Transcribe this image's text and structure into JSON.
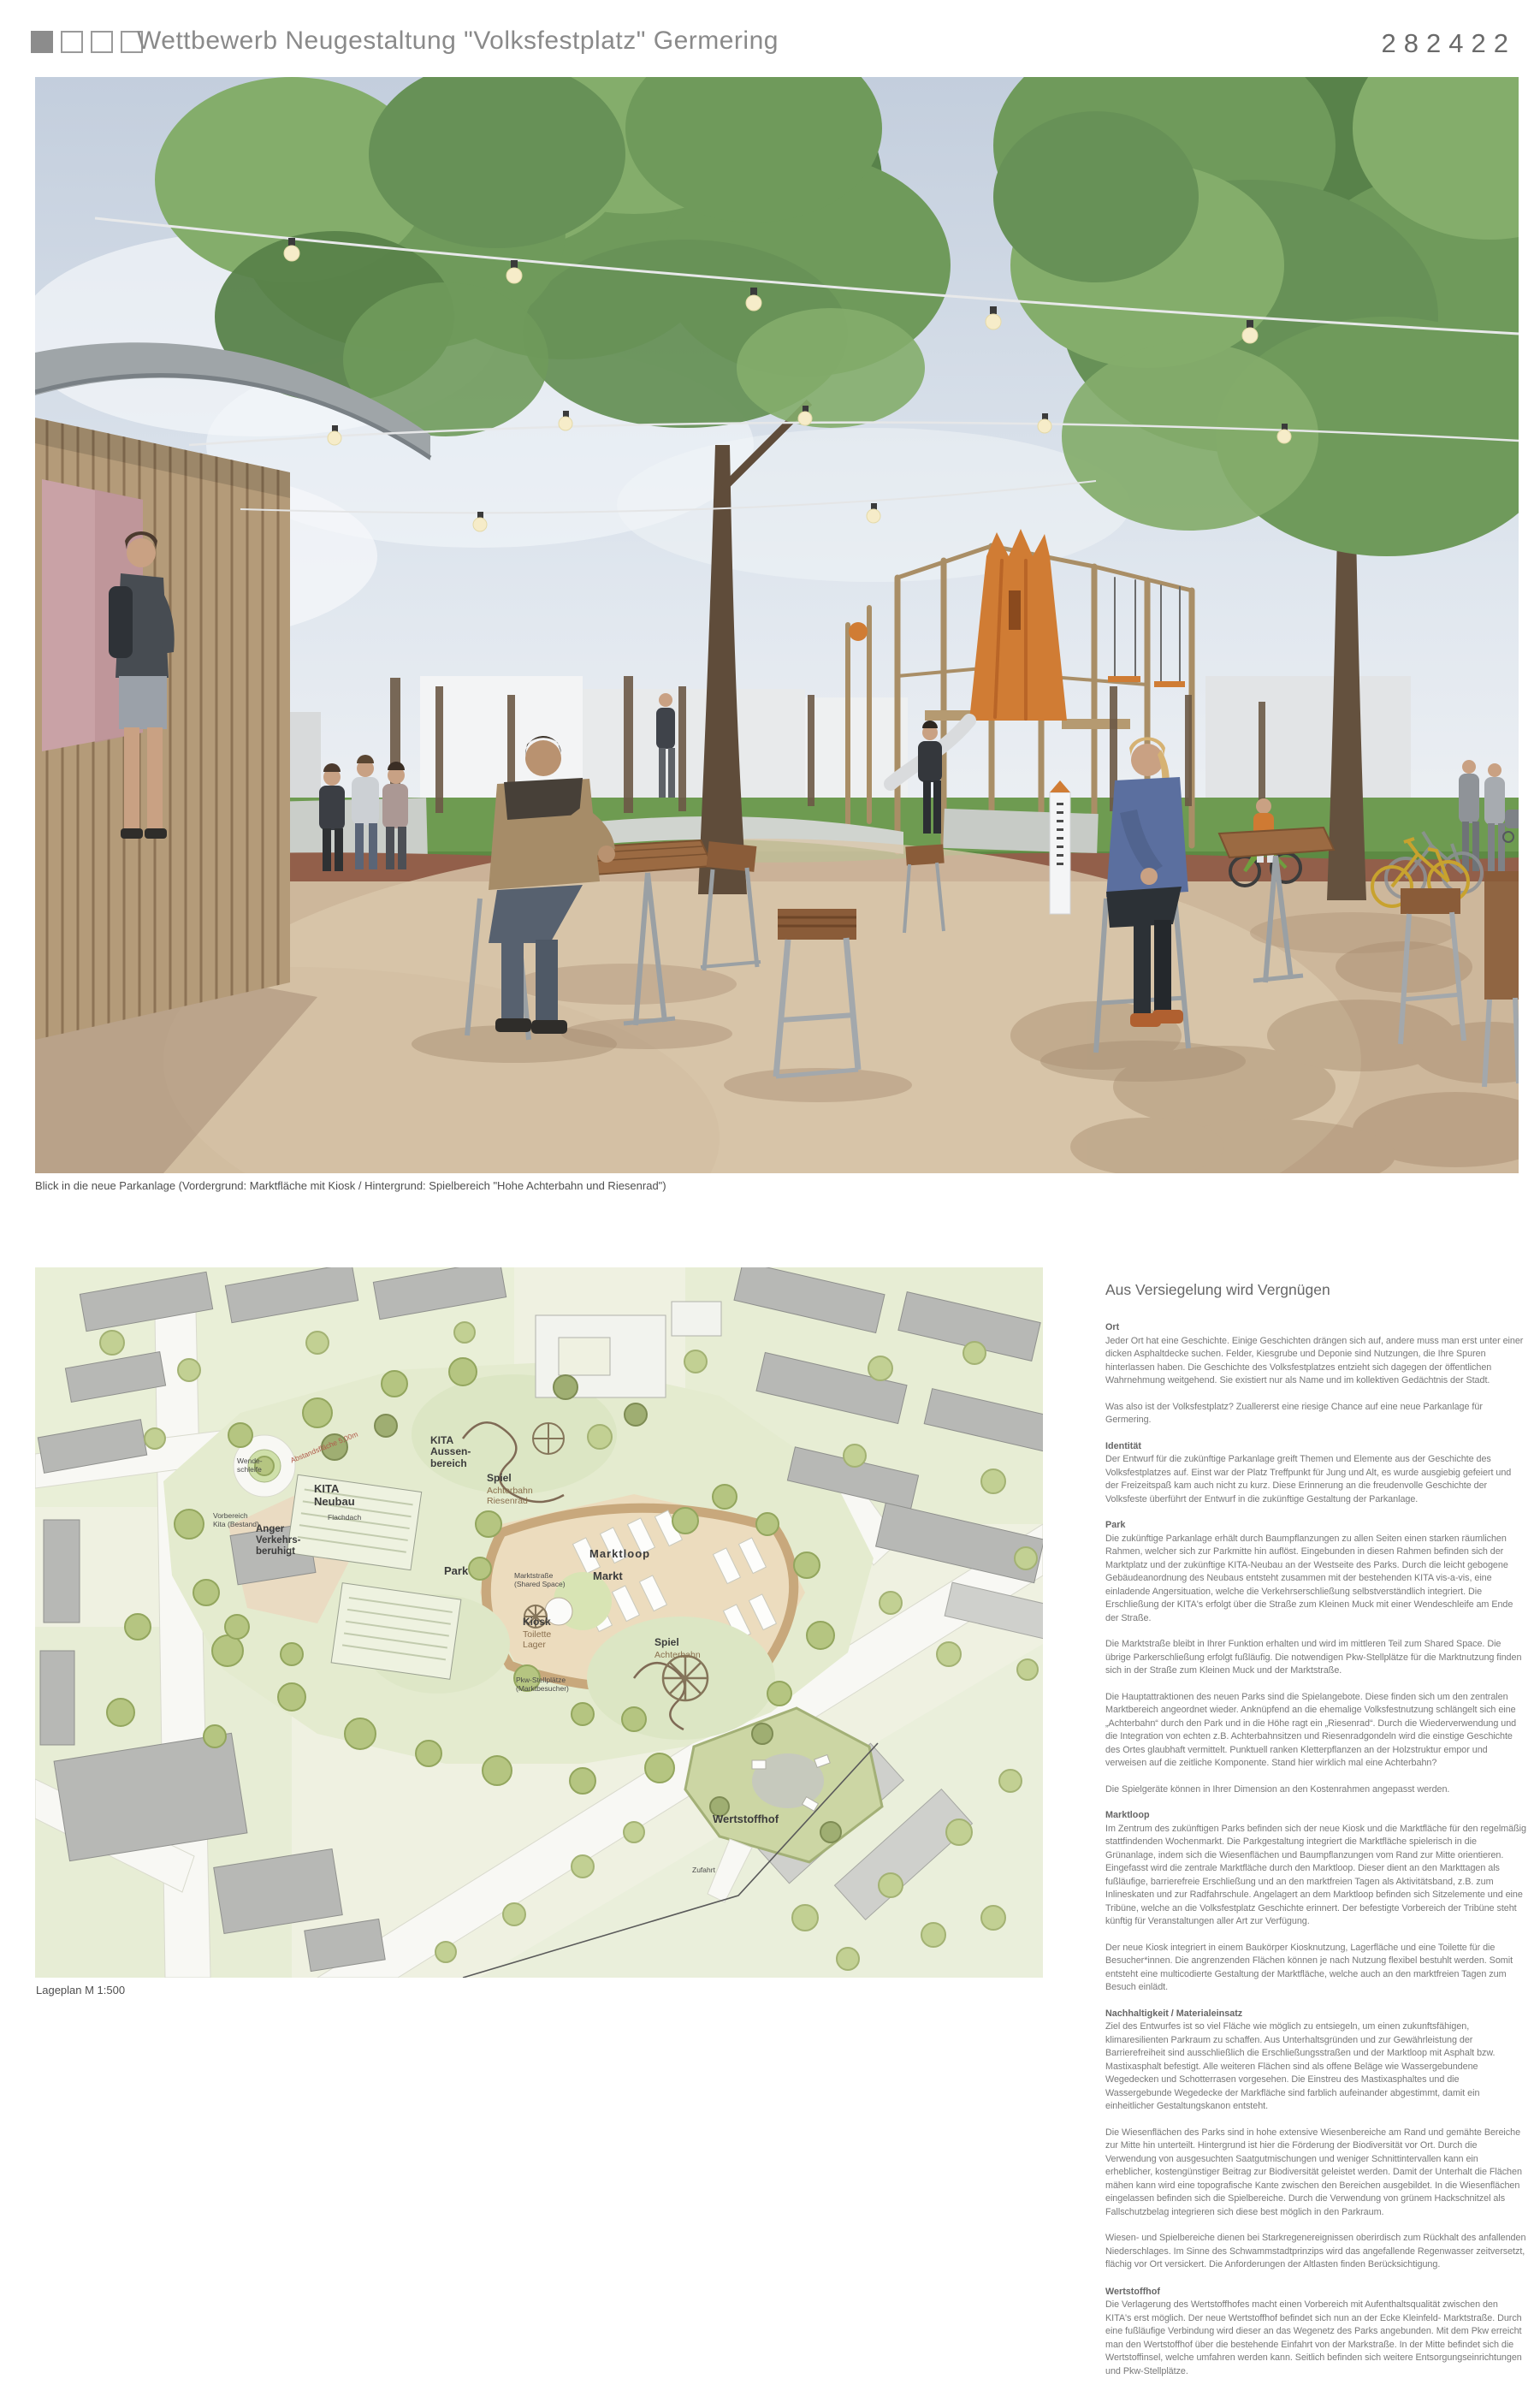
{
  "header": {
    "title": "Wettbewerb Neugestaltung \"Volksfestplatz\" Germering",
    "entry_number": "282422",
    "squares": {
      "filled": 1,
      "total": 4
    }
  },
  "rendering": {
    "caption": "Blick in die neue Parkanlage (Vordergrund: Marktfläche mit Kiosk / Hintergrund: Spielbereich \"Hohe Achterbahn und Riesenrad\")"
  },
  "siteplan": {
    "caption": "Lageplan M 1:500",
    "labels": {
      "kita_neubau": "KITA\nNeubau",
      "flachdach": "Flachdach",
      "kita_aussenbereich": "KITA\nAussen-\nbereich",
      "spiel_top_titel": "Spiel",
      "spiel_top_sub": "Achterbahn\nRiesenrad",
      "park": "Park",
      "anger": "Anger\nVerkehrs-\nberuhigt",
      "wendeschleife": "Wende-\nschleife",
      "vorbereich_kita": "Vorbereich\nKita (Bestand)",
      "marktloop": "Marktloop",
      "markt": "Markt",
      "marktstrasse": "Marktstraße\n(Shared Space)",
      "kiosk_titel": "Kiosk",
      "kiosk_sub": "Toilette\nLager",
      "spiel_sued_titel": "Spiel",
      "spiel_sued_sub": "Achterbahn",
      "pkw": "Pkw-Stellplätze\n(Marktbesucher)",
      "wertstoffhof": "Wertstoffhof",
      "zufahrt": "Zufahrt",
      "abstandsflaeche": "Abstandsfläche 5,00m"
    }
  },
  "article": {
    "title": "Aus Versiegelung wird Vergnügen",
    "sections": [
      {
        "heading": "Ort",
        "paras": [
          "Jeder Ort hat eine Geschichte. Einige Geschichten drängen sich auf, andere muss man erst unter einer dicken Asphaltdecke suchen. Felder, Kiesgrube und Deponie sind Nutzungen, die Ihre Spuren hinterlassen haben. Die Geschichte des Volksfestplatzes entzieht sich dagegen der öffentlichen Wahrnehmung weitgehend. Sie existiert nur als Name und im kollektiven Gedächtnis der Stadt.",
          "Was also ist der Volksfestplatz? Zuallererst eine riesige Chance auf eine neue Parkanlage für Germering."
        ]
      },
      {
        "heading": "Identität",
        "paras": [
          "Der Entwurf für die zukünftige Parkanlage greift Themen und Elemente aus der Geschichte des Volksfestplatzes auf. Einst war der Platz Treffpunkt für Jung und Alt, es wurde ausgiebig gefeiert und der Freizeitspaß kam auch nicht zu kurz. Diese Erinnerung an die freudenvolle Geschichte der Volksfeste überführt der Entwurf in die zukünftige Gestaltung der Parkanlage."
        ]
      },
      {
        "heading": "Park",
        "paras": [
          "Die zukünftige Parkanlage erhält durch Baumpflanzungen zu allen Seiten einen starken räumlichen Rahmen, welcher sich zur Parkmitte hin auflöst. Eingebunden in diesen Rahmen befinden sich der Marktplatz und der zukünftige KITA-Neubau an der Westseite des Parks. Durch die leicht gebogene Gebäudeanordnung des Neubaus entsteht zusammen mit der bestehenden KITA vis-a-vis, eine einladende Angersituation, welche die Verkehrserschließung selbstverständlich integriert. Die Erschließung der KITA's erfolgt über die Straße zum Kleinen Muck mit einer Wendeschleife am Ende der Straße.",
          "Die Marktstraße bleibt in Ihrer Funktion erhalten und wird im mittleren Teil zum Shared Space. Die übrige Parkerschließung erfolgt fußläufig. Die notwendigen Pkw-Stellplätze für die Marktnutzung finden sich in der Straße zum Kleinen Muck und der Marktstraße.",
          "Die Hauptattraktionen des neuen Parks sind die Spielangebote. Diese finden sich um den zentralen Marktbereich angeordnet wieder. Anknüpfend an die ehemalige Volksfestnutzung schlängelt sich eine „Achterbahn“ durch den Park und in die Höhe ragt ein „Riesenrad“. Durch die Wiederverwendung und die Integration von echten z.B. Achterbahnsitzen und Riesenradgondeln wird die einstige Geschichte des Ortes glaubhaft vermittelt. Punktuell ranken Kletterpflanzen an der Holzstruktur empor und verweisen auf die zeitliche Komponente. Stand hier wirklich mal eine Achterbahn?",
          "Die Spielgeräte können in Ihrer Dimension an den Kostenrahmen angepasst werden."
        ]
      },
      {
        "heading": "Marktloop",
        "paras": [
          "Im Zentrum des zukünftigen Parks befinden sich der neue Kiosk und die Marktfläche für den regelmäßig stattfindenden Wochenmarkt. Die Parkgestaltung integriert die Marktfläche spielerisch in die Grünanlage, indem sich die Wiesenflächen und Baumpflanzungen vom Rand zur Mitte orientieren. Eingefasst wird die zentrale Marktfläche durch den Marktloop. Dieser dient an den Markttagen als fußläufige, barrierefreie Erschließung und an den marktfreien Tagen als Aktivitätsband, z.B. zum Inlineskaten und zur Radfahrschule. Angelagert an dem Marktloop befinden sich Sitzelemente und eine Tribüne, welche an die Volksfestplatz Geschichte erinnert. Der befestigte Vorbereich der Tribüne steht künftig für Veranstaltungen aller Art zur Verfügung.",
          "Der neue Kiosk integriert in einem Baukörper Kiosknutzung, Lagerfläche und eine Toilette für die Besucher*innen. Die angrenzenden Flächen können je nach Nutzung flexibel bestuhlt werden. Somit entsteht eine multicodierte Gestaltung der Marktfläche, welche auch an den marktfreien Tagen zum Besuch einlädt."
        ]
      },
      {
        "heading": "Nachhaltigkeit / Materialeinsatz",
        "paras": [
          "Ziel des Entwurfes ist so viel Fläche wie möglich zu entsiegeln, um einen zukunftsfähigen, klimaresilienten Parkraum zu schaffen. Aus Unterhaltsgründen und zur Gewährleistung der Barrierefreiheit sind ausschließlich die Erschließungsstraßen und der Marktloop mit Asphalt bzw. Mastixasphalt befestigt. Alle weiteren Flächen sind als offene Beläge wie Wassergebundene Wegedecken und Schotterrasen vorgesehen. Die Einstreu des Mastixasphaltes und die Wassergebunde Wegedecke der Markfläche sind farblich aufeinander abgestimmt, damit ein einheitlicher Gestaltungskanon entsteht.",
          "Die Wiesenflächen des Parks sind in hohe extensive Wiesenbereiche am Rand und gemähte Bereiche zur Mitte hin unterteilt. Hintergrund ist hier die Förderung der Biodiversität vor Ort. Durch die Verwendung von ausgesuchten Saatgutmischungen und weniger Schnittintervallen kann ein erheblicher, kostengünstiger Beitrag zur Biodiversität geleistet werden. Damit der Unterhalt die Flächen mähen kann wird eine topografische Kante zwischen den Bereichen ausgebildet. In die Wiesenflächen eingelassen befinden sich die Spielbereiche. Durch die Verwendung von grünem Hackschnitzel als Fallschutzbelag integrieren sich diese best möglich in den Parkraum.",
          "Wiesen- und Spielbereiche dienen bei Starkregenereignissen oberirdisch zum Rückhalt des anfallenden Niederschlages. Im Sinne des Schwammstadtprinzips wird das angefallende Regenwasser zeitversetzt, flächig vor Ort versickert. Die Anforderungen der Altlasten finden Berücksichtigung."
        ]
      },
      {
        "heading": "Wertstoffhof",
        "paras": [
          "Die Verlagerung des Wertstoffhofes macht einen Vorbereich mit Aufenthaltsqualität zwischen den KITA's erst möglich. Der neue Wertstoffhof befindet sich nun an der Ecke Kleinfeld- Marktstraße. Durch eine fußläufige Verbindung wird dieser an das Wegenetz des Parks angebunden. Mit dem Pkw erreicht man den Wertstoffhof über die bestehende Einfahrt von der Markstraße. In der Mitte befindet sich die Wertstoffinsel, welche umfahren werden kann. Seitlich befinden sich weitere Entsorgungseinrichtungen und Pkw-Stellplätze."
        ]
      }
    ]
  },
  "colors": {
    "accent_orange": "#d07c34",
    "tree_green": "#6f9a5b",
    "plan_green": "#b5c581",
    "sand": "#cdb79b",
    "mulch_red": "#925f4a",
    "text_grey": "#787878"
  }
}
